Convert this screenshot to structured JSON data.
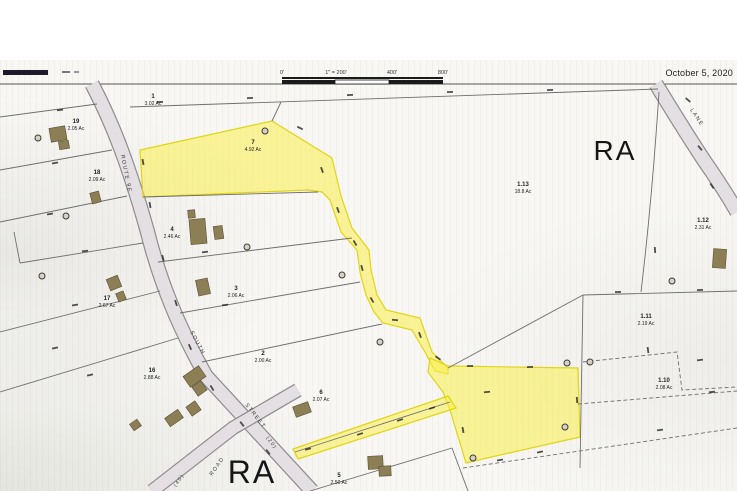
{
  "meta": {
    "date_label": "October 5, 2020"
  },
  "colors": {
    "highlight_fill": "#f9ef4a",
    "highlight_stroke": "#ded200",
    "road_fill": "#e3dfe3",
    "road_edge": "#8f8b8f",
    "line": "#6f6f6f",
    "building_fill": "#8d7f55",
    "building_stroke": "#5a5134",
    "text": "#1f1f1f",
    "legend_bar": "#1b1b2a"
  },
  "zone_labels": [
    {
      "text": "RA",
      "x": 615,
      "y": 160,
      "size": 28
    },
    {
      "text": "RA",
      "x": 252,
      "y": 483,
      "size": 32
    }
  ],
  "scalebar": {
    "x": 282,
    "y": 77,
    "width": 161,
    "labels": [
      "0'",
      "1\" = 200'",
      "400'",
      "800'"
    ],
    "label_x": [
      282,
      336,
      392,
      443
    ]
  },
  "legend_bar": {
    "x": 3,
    "y": 70,
    "width": 45,
    "height": 5
  },
  "border_line_y": 84,
  "roads": [
    {
      "name": "route-9e-south-street",
      "path": "M92,84 C115,128 130,170 147,230 C160,282 178,326 206,376 L312,491",
      "width": 13
    },
    {
      "name": "cross-road",
      "path": "M298,390 L233,428 L152,491",
      "width": 12
    },
    {
      "name": "lane",
      "path": "M656,84 C675,115 695,148 712,172 C724,190 732,203 737,212",
      "width": 13
    }
  ],
  "road_labels": [
    {
      "text": "ROUTE 9E",
      "x": 121,
      "y": 155,
      "rot": 79,
      "size": 5.5
    },
    {
      "text": "SOUTH",
      "x": 190,
      "y": 332,
      "rot": 62,
      "size": 5.5
    },
    {
      "text": "STREET",
      "x": 245,
      "y": 405,
      "rot": 52,
      "size": 5.5
    },
    {
      "text": "(20)",
      "x": 266,
      "y": 438,
      "rot": 52,
      "size": 5
    },
    {
      "text": "ROAD",
      "x": 212,
      "y": 476,
      "rot": -55,
      "size": 5.5
    },
    {
      "text": "(40)",
      "x": 176,
      "y": 487,
      "rot": -55,
      "size": 5
    },
    {
      "text": "LANE",
      "x": 690,
      "y": 110,
      "rot": 56,
      "size": 5.5
    }
  ],
  "yellow_parcels": [
    {
      "id": "parcel-7-with-corridor",
      "path": "M140,150 L272,121 L332,158 L341,196 L352,228 L369,250 L371,270 L377,295 L386,310 L420,318 L432,352 L448,368 L448,374 L435,371 L425,352 L412,330 L383,323 L374,312 L366,295 L360,272 L357,250 L341,232 L330,200 L322,192 L308,190 L143,197 Z"
    },
    {
      "id": "large-rear-parcel",
      "path": "M430,358 L448,366 L578,368 L580,437 L487,458 L466,463 L450,410 L443,392 L428,372 Z"
    },
    {
      "id": "access-strip",
      "path": "M448,396 L456,408 L298,459 L293,449 Z"
    }
  ],
  "boundaries_solid": [
    [
      130,
      107,
      658,
      89
    ],
    [
      272,
      121,
      281,
      102
    ],
    [
      97,
      104,
      0,
      117
    ],
    [
      112,
      150,
      0,
      170
    ],
    [
      127,
      196,
      0,
      222
    ],
    [
      143,
      243,
      20,
      263
    ],
    [
      20,
      263,
      14,
      232
    ],
    [
      160,
      291,
      0,
      332
    ],
    [
      178,
      338,
      0,
      392
    ],
    [
      143,
      197,
      318,
      192
    ],
    [
      158,
      262,
      352,
      238
    ],
    [
      180,
      313,
      360,
      282
    ],
    [
      202,
      362,
      382,
      324
    ],
    [
      295,
      452,
      450,
      402
    ],
    [
      310,
      491,
      452,
      448
    ],
    [
      452,
      448,
      468,
      491
    ],
    [
      448,
      368,
      583,
      295
    ],
    [
      583,
      295,
      737,
      291
    ],
    [
      583,
      295,
      580,
      468
    ]
  ],
  "boundaries_curved": [
    "M659,92 Q652,200 641,292"
  ],
  "boundaries_dashed": [
    "M583,362 L677,352 L682,390 L737,387",
    "M578,404 L737,391",
    "M463,468 L737,428"
  ],
  "parcel_labels": [
    {
      "num": "1",
      "ac": "3.02 Ac",
      "x": 153,
      "y": 98
    },
    {
      "num": "19",
      "ac": "2.05 Ac",
      "x": 76,
      "y": 123
    },
    {
      "num": "18",
      "ac": "2.09 Ac",
      "x": 97,
      "y": 174
    },
    {
      "num": "17",
      "ac": "2.67 Ac",
      "x": 107,
      "y": 300
    },
    {
      "num": "16",
      "ac": "2.88 Ac",
      "x": 152,
      "y": 372
    },
    {
      "num": "4",
      "ac": "2.46 Ac",
      "x": 172,
      "y": 231
    },
    {
      "num": "3",
      "ac": "2.06 Ac",
      "x": 236,
      "y": 290
    },
    {
      "num": "2",
      "ac": "2.00 Ac",
      "x": 263,
      "y": 355
    },
    {
      "num": "6",
      "ac": "2.07 Ac",
      "x": 321,
      "y": 394
    },
    {
      "num": "5",
      "ac": "2.50 Ac",
      "x": 339,
      "y": 477
    },
    {
      "num": "7",
      "ac": "4.92 Ac",
      "x": 253,
      "y": 144
    },
    {
      "num": "1.13",
      "ac": "18.8 Ac",
      "x": 523,
      "y": 186
    },
    {
      "num": "1.12",
      "ac": "2.31 Ac",
      "x": 703,
      "y": 222
    },
    {
      "num": "1.11",
      "ac": "2.19 Ac",
      "x": 646,
      "y": 318
    },
    {
      "num": "1.10",
      "ac": "2.08 Ac",
      "x": 664,
      "y": 382
    }
  ],
  "buildings": [
    [
      50,
      127,
      16,
      14,
      -10
    ],
    [
      59,
      141,
      10,
      8,
      -10
    ],
    [
      91,
      192,
      9,
      11,
      -15
    ],
    [
      188,
      210,
      7,
      8,
      -5
    ],
    [
      190,
      219,
      16,
      25,
      -5
    ],
    [
      214,
      226,
      9,
      13,
      -8
    ],
    [
      197,
      279,
      12,
      16,
      -12
    ],
    [
      108,
      277,
      12,
      12,
      -22
    ],
    [
      117,
      292,
      8,
      9,
      -22
    ],
    [
      185,
      370,
      19,
      13,
      -35
    ],
    [
      194,
      383,
      11,
      11,
      -35
    ],
    [
      188,
      403,
      11,
      11,
      -35
    ],
    [
      166,
      413,
      16,
      10,
      -35
    ],
    [
      131,
      421,
      9,
      8,
      -35
    ],
    [
      294,
      404,
      16,
      11,
      -20
    ],
    [
      368,
      456,
      15,
      13,
      -3
    ],
    [
      379,
      466,
      12,
      10,
      -3
    ],
    [
      713,
      249,
      13,
      19,
      4
    ]
  ],
  "wells": [
    [
      38,
      138
    ],
    [
      66,
      216
    ],
    [
      265,
      131
    ],
    [
      342,
      275
    ],
    [
      380,
      342
    ],
    [
      42,
      276
    ],
    [
      473,
      458
    ],
    [
      567,
      363
    ],
    [
      590,
      362
    ],
    [
      565,
      427
    ],
    [
      672,
      281
    ],
    [
      247,
      247
    ]
  ],
  "dim_marks": [
    [
      160,
      102,
      -3
    ],
    [
      250,
      98,
      -3
    ],
    [
      350,
      95,
      -3
    ],
    [
      450,
      92,
      -3
    ],
    [
      550,
      90,
      -2
    ],
    [
      300,
      128,
      25
    ],
    [
      322,
      170,
      70
    ],
    [
      338,
      210,
      70
    ],
    [
      355,
      243,
      60
    ],
    [
      362,
      268,
      75
    ],
    [
      372,
      300,
      60
    ],
    [
      395,
      320,
      5
    ],
    [
      420,
      335,
      70
    ],
    [
      438,
      358,
      35
    ],
    [
      470,
      366,
      -2
    ],
    [
      530,
      367,
      -2
    ],
    [
      577,
      400,
      85
    ],
    [
      540,
      452,
      -12
    ],
    [
      500,
      460,
      -10
    ],
    [
      463,
      430,
      80
    ],
    [
      360,
      434,
      -18
    ],
    [
      400,
      420,
      -18
    ],
    [
      432,
      408,
      -18
    ],
    [
      308,
      449,
      -15
    ],
    [
      618,
      292,
      -2
    ],
    [
      700,
      290,
      -2
    ],
    [
      688,
      100,
      40
    ],
    [
      700,
      148,
      50
    ],
    [
      712,
      186,
      55
    ],
    [
      655,
      250,
      85
    ],
    [
      648,
      350,
      82
    ],
    [
      700,
      360,
      -8
    ],
    [
      712,
      392,
      -6
    ],
    [
      660,
      430,
      -8
    ],
    [
      60,
      110,
      -7
    ],
    [
      55,
      163,
      -9
    ],
    [
      50,
      214,
      -9
    ],
    [
      85,
      251,
      -7
    ],
    [
      75,
      305,
      -10
    ],
    [
      55,
      348,
      -12
    ],
    [
      90,
      375,
      -12
    ],
    [
      143,
      162,
      80
    ],
    [
      150,
      205,
      80
    ],
    [
      163,
      258,
      76
    ],
    [
      176,
      303,
      72
    ],
    [
      190,
      347,
      66
    ],
    [
      212,
      388,
      58
    ],
    [
      242,
      424,
      52
    ],
    [
      268,
      452,
      52
    ],
    [
      205,
      252,
      -8
    ],
    [
      225,
      305,
      -8
    ],
    [
      487,
      392,
      -5
    ]
  ]
}
